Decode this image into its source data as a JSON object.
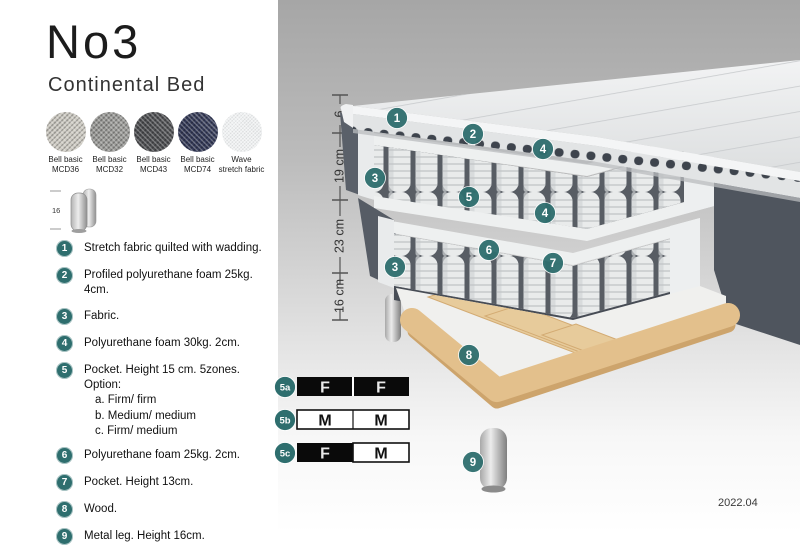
{
  "left_panel": {
    "title": "No3",
    "subtitle": "Continental Bed",
    "swatches": [
      {
        "line1": "Bell basic",
        "line2": "MCD36",
        "color": "#cfccc4"
      },
      {
        "line1": "Bell basic",
        "line2": "MCD32",
        "color": "#9b9b98"
      },
      {
        "line1": "Bell basic",
        "line2": "MCD43",
        "color": "#4e4f52"
      },
      {
        "line1": "Bell basic",
        "line2": "MCD74",
        "color": "#343a58"
      },
      {
        "line1": "Wave",
        "line2": "stretch fabric",
        "color": "#eef0f1"
      }
    ],
    "leg_icon_label": "16",
    "list_items": [
      {
        "num": "1",
        "text": "Stretch fabric quilted with wadding."
      },
      {
        "num": "2",
        "text": "Profiled polyurethane foam 25kg. 4cm."
      },
      {
        "num": "3",
        "text": "Fabric."
      },
      {
        "num": "4",
        "text": "Polyurethane foam 30kg. 2cm."
      },
      {
        "num": "5",
        "text": "Pocket. Height 15 cm. 5zones. Option:",
        "sub_a": "a. Firm/ firm",
        "sub_b": "b. Medium/ medium",
        "sub_c": "c. Firm/ medium"
      },
      {
        "num": "6",
        "text": "Polyurethane foam 25kg. 2cm."
      },
      {
        "num": "7",
        "text": "Pocket. Height 13cm."
      },
      {
        "num": "8",
        "text": "Wood."
      },
      {
        "num": "9",
        "text": "Metal leg. Height 16cm."
      }
    ]
  },
  "diagram": {
    "measurements": {
      "top": "6",
      "mid": "19 cm",
      "lower": "23 cm",
      "leg": "16 cm"
    },
    "markers": {
      "m1": "1",
      "m2": "2",
      "m3a": "3",
      "m3b": "3",
      "m4a": "4",
      "m4b": "4",
      "m5": "5",
      "m6": "6",
      "m7": "7",
      "m8": "8",
      "m9": "9"
    },
    "firmness": {
      "row_a": {
        "id": "5a",
        "cell1": "F",
        "cell2": "F"
      },
      "row_b": {
        "id": "5b",
        "cell1": "M",
        "cell2": "M"
      },
      "row_c": {
        "id": "5c",
        "cell1": "F",
        "cell2": "M"
      }
    },
    "date": "2022.04"
  },
  "colors": {
    "marker_teal": "#2e6e6e",
    "dark_fabric": "#565c66",
    "wood": "#e3c08c",
    "firmness_dark_cell": "#0a0a0a",
    "panel_gray_top": "#a6a6a6"
  }
}
